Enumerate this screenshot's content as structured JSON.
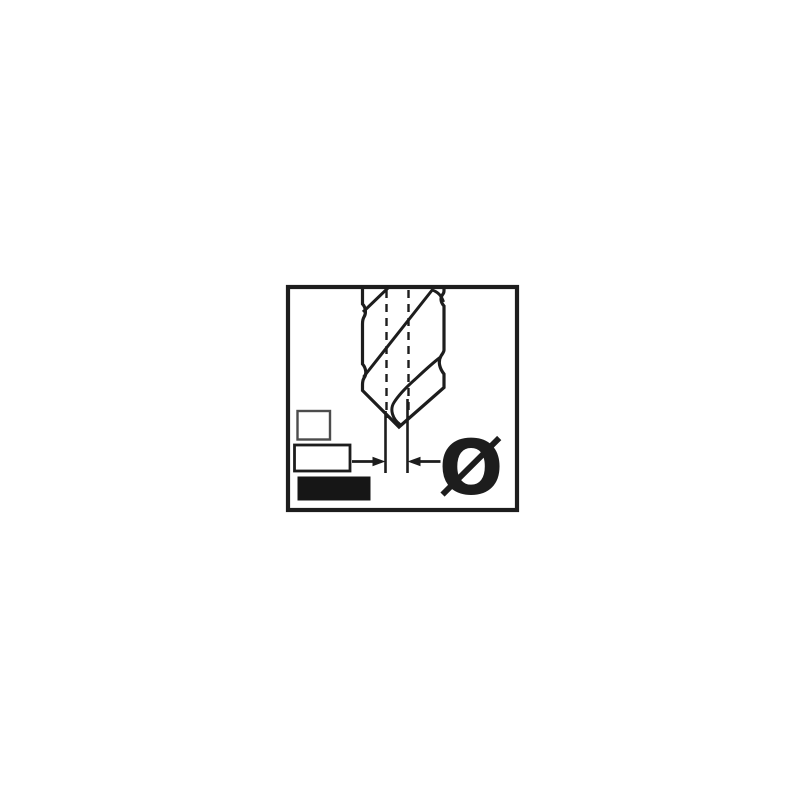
{
  "page": {
    "background_color": "#ffffff"
  },
  "illustration": {
    "name": "drill-bit-diameter-icon",
    "description": "Black-and-white technical line drawing of a twist drill bit tip inside a square frame, with dashed centerlines, vertical extension lines, inward-pointing dimension arrows and a diameter symbol",
    "ink_color": "#1d1d1d",
    "panel_border_color": "#1d1d1d"
  },
  "dimension": {
    "symbol": "Ø",
    "meaning": "diameter"
  },
  "swatches": [
    {
      "name": "small-rectangle",
      "fill": "#ffffff",
      "border": "#4c4c4c"
    },
    {
      "name": "medium-rectangle",
      "fill": "#ffffff",
      "border": "#1d1d1d"
    },
    {
      "name": "large-rectangle",
      "fill": "#161616",
      "border": "#161616"
    }
  ]
}
